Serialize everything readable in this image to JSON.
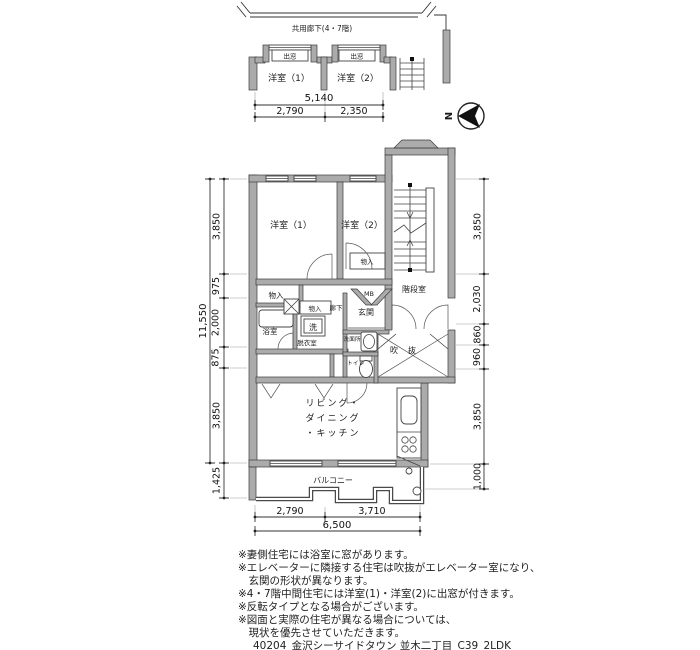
{
  "drawing_title": "40204_金沢シーサイドタウン 並木二丁目_C39_2LDK",
  "compass": {
    "north_label": "N"
  },
  "upper_plan": {
    "corridor_label": "共用廊下(4・7階)",
    "bay_window_1": "出窓",
    "bay_window_2": "出窓",
    "room_1": "洋室（1）",
    "room_2": "洋室（2）"
  },
  "rooms": {
    "western_room_1": "洋室（1）",
    "western_room_2": "洋室（2）",
    "closet_room2": "物入",
    "closet_top": "物入",
    "closet_small": "物入",
    "closet_bottom": "物入",
    "meter_box": "MB",
    "stair_hall": "階段室",
    "bathroom": "浴室",
    "washer": "洗",
    "dressing_room": "脱衣室",
    "hallway": "廊下",
    "entrance": "玄関",
    "washroom": "洗面所",
    "toilet": "トイレ",
    "void_space": "吹抜",
    "ldk_line1": "リビング・",
    "ldk_line2": "ダイニング",
    "ldk_line3": "・キッチン",
    "balcony": "バルコニー"
  },
  "dimensions": {
    "top": {
      "total": "5,140",
      "seg1": "2,790",
      "seg2": "2,350"
    },
    "bottom": {
      "seg1": "2,790",
      "seg2": "3,710",
      "total": "6,500"
    },
    "left": {
      "total": "11,550",
      "seg1": "3,850",
      "seg2": "975",
      "seg3": "2,000",
      "seg4": "875",
      "seg5": "3,850",
      "seg6": "1,425"
    },
    "right": {
      "seg1": "3,850",
      "seg2": "2,030",
      "seg3": "860",
      "seg4": "960",
      "seg5": "3,850",
      "seg6": "1,000"
    }
  },
  "notes": [
    "※妻側住宅には浴室に窓があります。",
    "※エレベーターに隣接する住宅は吹抜がエレベーター室になり、",
    "　玄関の形状が異なります。",
    "※4・7階中間住宅には洋室(1)・洋室(2)に出窓が付きます。",
    "※反転タイプとなる場合がございます。",
    "※図面と実際の住宅が異なる場合については、",
    "　現状を優先させていただきます。"
  ]
}
